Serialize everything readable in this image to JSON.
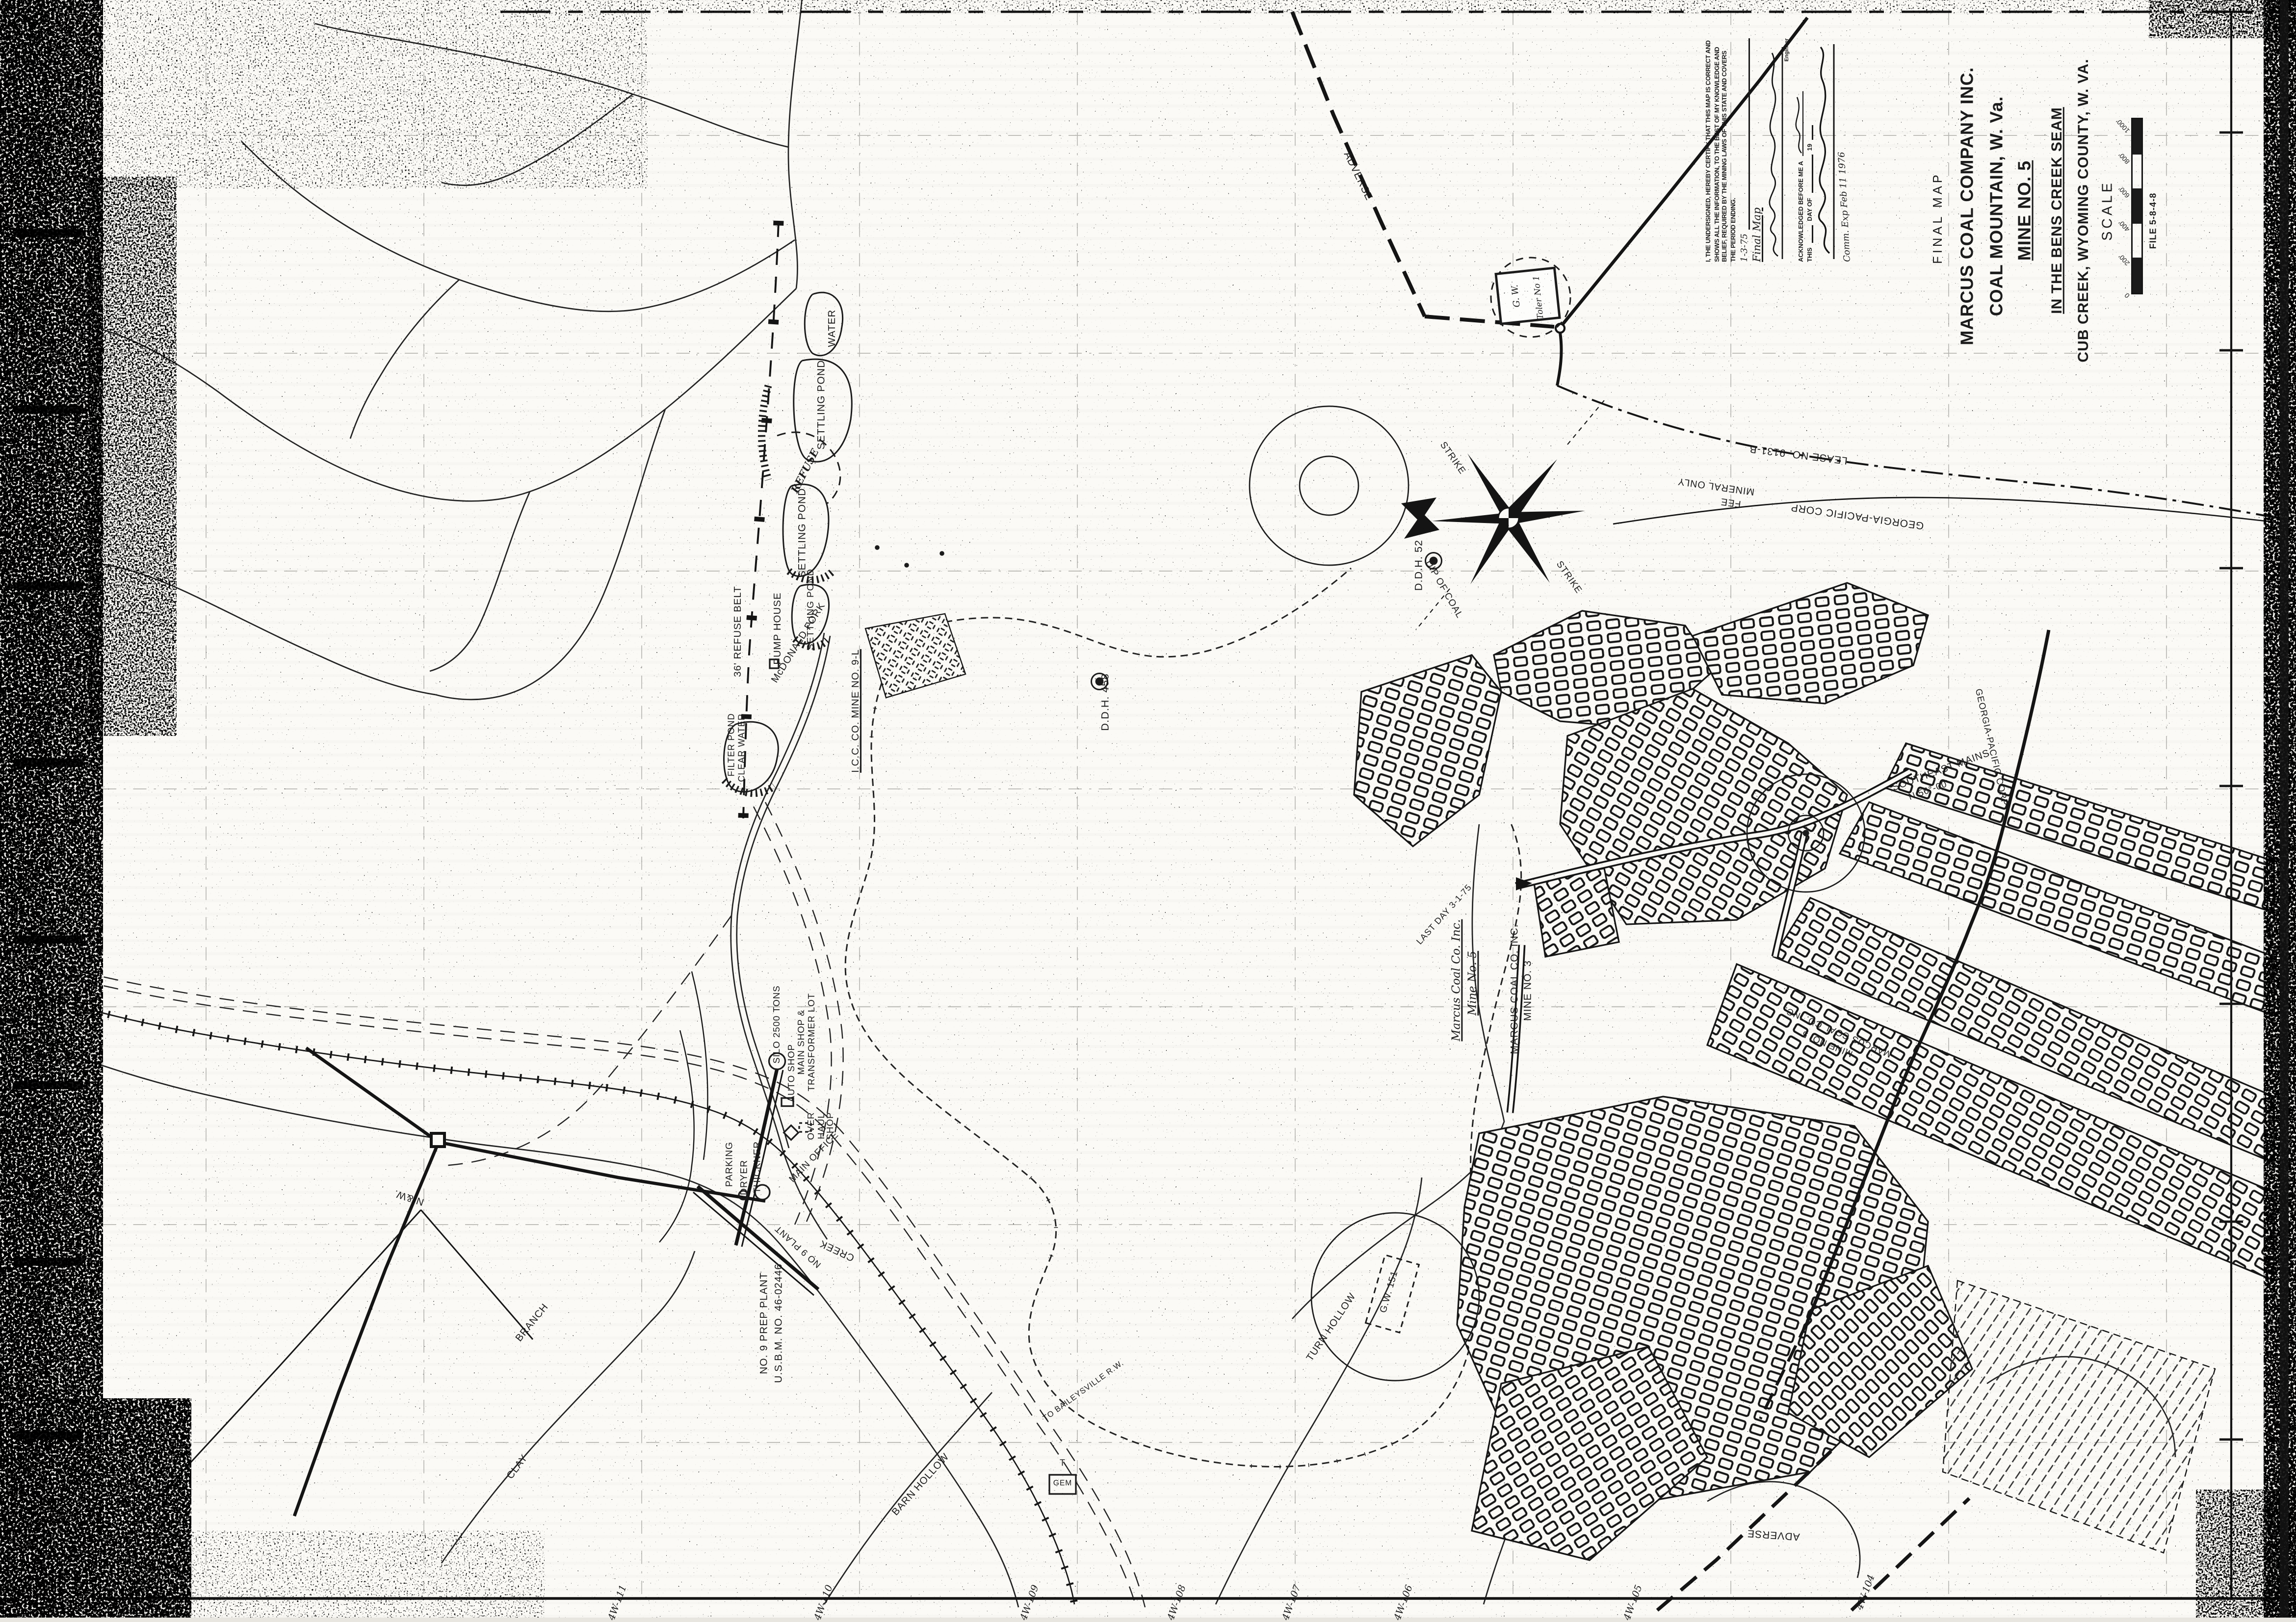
{
  "page": {
    "paper_color": "#fbfaf6",
    "ink_color": "#1b1b1b"
  },
  "title_block": {
    "map_type": "FINAL MAP",
    "company": "MARCUS COAL COMPANY INC.",
    "location_line": "COAL MOUNTAIN, W. Va.",
    "mine": "MINE NO. 5",
    "seam": "IN THE BENS CREEK SEAM",
    "county": "CUB CREEK, WYOMING COUNTY, W. VA.",
    "scale_label": "SCALE",
    "file_label": "FILE  5-8-4-8",
    "scale_ticks": [
      "0",
      "200'",
      "400'",
      "600'",
      "800'",
      "1000'"
    ]
  },
  "certification": {
    "body": "I, THE UNDERSIGNED, HEREBY CERTIFY THAT THIS MAP IS CORRECT AND SHOWS ALL THE INFORMATION, TO THE BEST OF MY KNOWLEDGE AND BELIEF, REQUIRED BY THE MINING LAWS OF THIS STATE AND COVERS THE PERIOD ENDING.",
    "period_ending_value": "1-3-75",
    "map_note": "Final Map",
    "engineer_label": "Engineer",
    "acknowledged_line": "ACKNOWLEDGED BEFORE ME A",
    "this_label": "THIS",
    "day_of_label": "DAY OF",
    "year_prefix": "19",
    "commission": "Comm. Exp Feb 11 1976"
  },
  "compass": {
    "strike_upper": "STRIKE",
    "strike_lower": "STRIKE",
    "dip": "DIP OF COAL"
  },
  "labels": {
    "water": "WATER",
    "settling_pond_upper": "SETTLING POND",
    "refuse": "REFUSE",
    "settling_pond_middle": "SETTLING POND",
    "settling_pond_lower": "SETTLING POND",
    "refuse_belt": "36' REFUSE BELT",
    "pump_house": "PUMP HOUSE",
    "mcdonald_fork": "McDONALD FORK",
    "mine_9l": "I.C.C. CO. MINE NO. 9-L",
    "filter_pond": "FILTER POND",
    "clear_water": "CLEAR WATER",
    "ddh_458": "D.D.H. 458",
    "ddh_52": "D.D.H. 52",
    "georgia_pacific": "GEORGIA-PACIFIC CORP",
    "mineral_only": "MINERAL ONLY",
    "fee": "FEE",
    "lease_no": "LEASE NO. 9131-B",
    "adverse_top": "ADVERSE",
    "adverse_bottom": "ADVERSE",
    "gw_toler_line1": "G. W.",
    "gw_toler_line2": "Toler No 1",
    "gw_151": "G.W. 151",
    "marcus5_script1": "Marcus Coal Co. Inc.",
    "marcus5_script2": "Mine No. 5",
    "marcus3_line1": "MARCUS COAL CO. INC.",
    "marcus3_line2": "MINE NO. 3",
    "last_day": "LAST DAY 3-1-75",
    "mains_owner1": "MARCUS COAL CO. INC.",
    "mains_owner2": "MINE NO. 5",
    "southeast_mains": "SOUTHEAST MAINS",
    "bearing": "N 56°-00'",
    "gp_boundary": "GEORGIA-PACIFIC CORP",
    "silo": "SILO 2500 TONS",
    "auto_shop": "AUTO SHOP",
    "main_shop": "MAIN SHOP & TRANSFORMER LOT",
    "overhaul_shop": "OVER HAUL SHOP",
    "main_office": "MAIN OFFICE",
    "parking": "PARKING",
    "dryer": "DRYER",
    "thickner": "THICKNER",
    "prep_plant": "NO. 9 PREP PLANT",
    "usbm": "U.S.B.M. NO. 46-02446",
    "no9_plant": "NO 9 PLANT",
    "creek": "CREEK",
    "railway": "N.&W.",
    "branch": "BRANCH",
    "clay": "CLAY",
    "barn_hollow": "BARN HOLLOW",
    "turn_hollow": "TURN HOLLOW",
    "gem": "GEM",
    "gem_t": "T",
    "baileysville": "TO BAILEYSVILLE R.W."
  },
  "grid_labels_bottom": [
    "4W-111",
    "4W-110",
    "4W-109",
    "4W-108",
    "4W-107",
    "4W-106",
    "4W-105",
    "4W-104"
  ]
}
